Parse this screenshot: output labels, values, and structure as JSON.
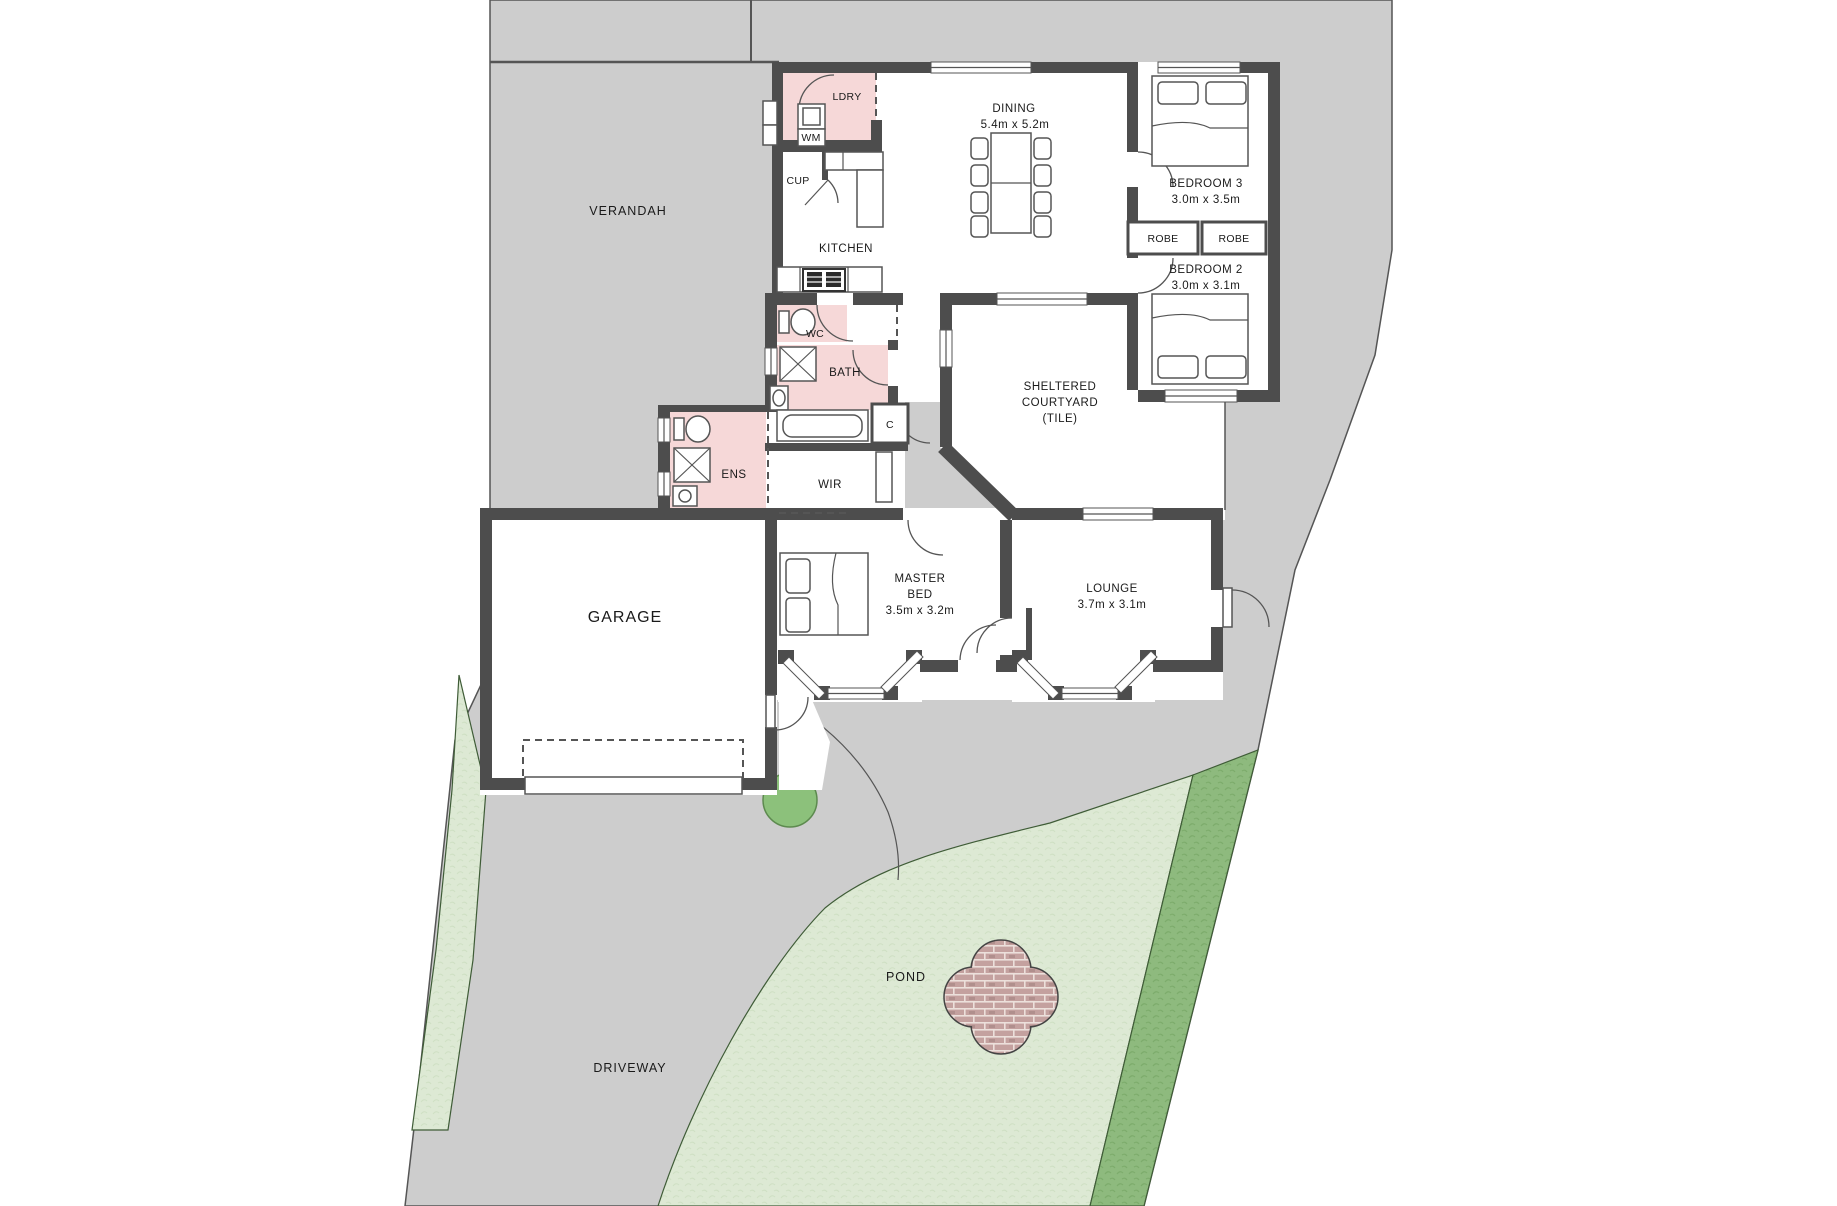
{
  "colors": {
    "site_gray": "#cdcdcd",
    "wall_dark": "#4d4d4d",
    "wet_area_pink": "#f6d8d8",
    "lawn_light_green": "#dde9d4",
    "garden_strip_green": "#8eba7e",
    "tree_green": "#8cc17b",
    "pond_brick": "#c4a19f",
    "outline": "#555555"
  },
  "outdoor": {
    "verandah_label": "VERANDAH",
    "driveway_label": "DRIVEWAY",
    "pond_label": "POND"
  },
  "rooms": {
    "laundry": {
      "name": "LDRY"
    },
    "washing_machine": {
      "name": "WM"
    },
    "cupboard": {
      "name": "CUP"
    },
    "kitchen": {
      "name": "KITCHEN"
    },
    "dining": {
      "name": "DINING",
      "dims": "5.4m x 5.2m"
    },
    "bedroom3": {
      "name": "BEDROOM 3",
      "dims": "3.0m x 3.5m"
    },
    "bedroom2": {
      "name": "BEDROOM 2",
      "dims": "3.0m x 3.1m"
    },
    "robe_left": {
      "name": "ROBE"
    },
    "robe_right": {
      "name": "ROBE"
    },
    "wc": {
      "name": "WC"
    },
    "bath": {
      "name": "BATH"
    },
    "linen": {
      "name": "C"
    },
    "ensuite": {
      "name": "ENS"
    },
    "wir": {
      "name": "WIR"
    },
    "courtyard": {
      "line1": "SHELTERED",
      "line2": "COURTYARD",
      "line3": "(TILE)"
    },
    "garage": {
      "name": "GARAGE"
    },
    "master": {
      "line1": "MASTER",
      "line2": "BED",
      "dims": "3.5m x 3.2m"
    },
    "lounge": {
      "name": "LOUNGE",
      "dims": "3.7m x 3.1m"
    }
  }
}
